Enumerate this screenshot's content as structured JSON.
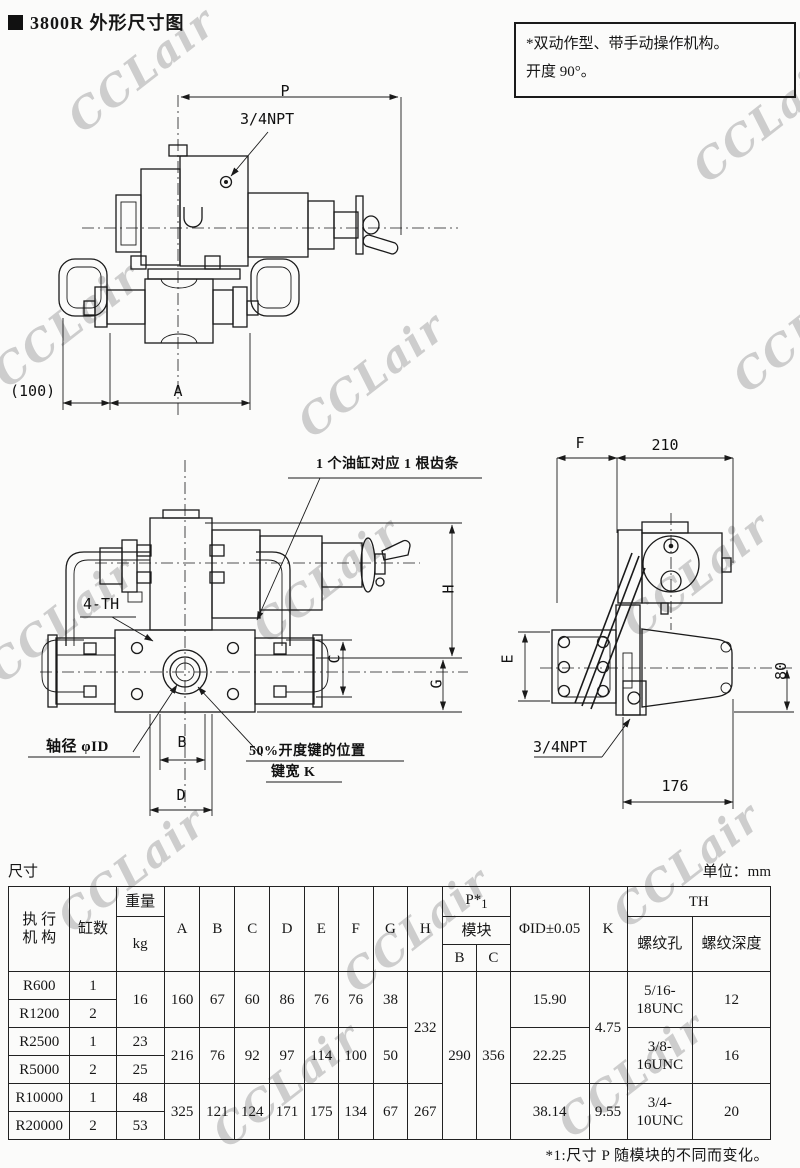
{
  "page": {
    "title_marker": "■",
    "title": "3800R 外形尺寸图",
    "watermark": "CCLair",
    "note_line1": "*双动作型、带手动操作机构。",
    "note_line2": "开度 90°。"
  },
  "drawing_top": {
    "dim_p": "P",
    "port_label": "3/4NPT",
    "dim_100": "(100)",
    "dim_a": "A"
  },
  "drawing_front": {
    "callout_rack": "1 个油缸对应 1 根齿条",
    "callout_4th": "4-TH",
    "dim_h": "H",
    "dim_c": "C",
    "dim_g": "G",
    "shaft_label": "轴径  φID",
    "dim_b": "B",
    "key_label_line1": "50%开度键的位置",
    "key_label_line2": "键宽  K",
    "dim_d": "D"
  },
  "drawing_side": {
    "dim_f": "F",
    "dim_210": "210",
    "dim_e": "E",
    "dim_80": "80",
    "port_label": "3/4NPT",
    "dim_176": "176"
  },
  "table": {
    "caption": "尺寸",
    "unit": "单位：mm",
    "header": {
      "actuator_line1": "执 行",
      "actuator_line2": "机 构",
      "cylinders": "缸数",
      "weight": "重量",
      "weight_unit": "kg",
      "a": "A",
      "b": "B",
      "c": "C",
      "d": "D",
      "e": "E",
      "f": "F",
      "g": "G",
      "h": "H",
      "p": "P*",
      "p_sub": "1",
      "module": "模块",
      "module_b": "B",
      "module_c": "C",
      "phi_id": "ΦID±0.05",
      "k": "K",
      "th": "TH",
      "thread_hole": "螺纹孔",
      "thread_depth": "螺纹深度"
    },
    "rows": [
      {
        "model": "R600",
        "cylinders": "1"
      },
      {
        "model": "R1200",
        "cylinders": "2"
      },
      {
        "model": "R2500",
        "cylinders": "1",
        "weight": "23"
      },
      {
        "model": "R5000",
        "cylinders": "2",
        "weight": "25"
      },
      {
        "model": "R10000",
        "cylinders": "1",
        "weight": "48"
      },
      {
        "model": "R20000",
        "cylinders": "2",
        "weight": "53"
      }
    ],
    "merged": {
      "weight_r600_r1200": "16",
      "dims_r600": {
        "a": "160",
        "b": "67",
        "c": "60",
        "d": "86",
        "e": "76",
        "f": "76",
        "g": "38"
      },
      "dims_r2500": {
        "a": "216",
        "b": "76",
        "c": "92",
        "d": "97",
        "e": "114",
        "f": "100",
        "g": "50"
      },
      "dims_r10000": {
        "a": "325",
        "b": "121",
        "c": "124",
        "d": "171",
        "e": "175",
        "f": "134",
        "g": "67"
      },
      "h_r600_r5000": "232",
      "h_r10000": "267",
      "module_b": "290",
      "module_c": "356",
      "id_r600": "15.90",
      "id_r2500": "22.25",
      "id_r10000": "38.14",
      "k_r600_r5000": "4.75",
      "k_r10000": "9.55",
      "th_r600": "5/16-18UNC",
      "th_r2500": "3/8-16UNC",
      "th_r10000": "3/4-10UNC",
      "depth_r600": "12",
      "depth_r2500": "16",
      "depth_r10000": "20"
    },
    "footnote": "*1:尺寸 P 随模块的不同而变化。"
  }
}
